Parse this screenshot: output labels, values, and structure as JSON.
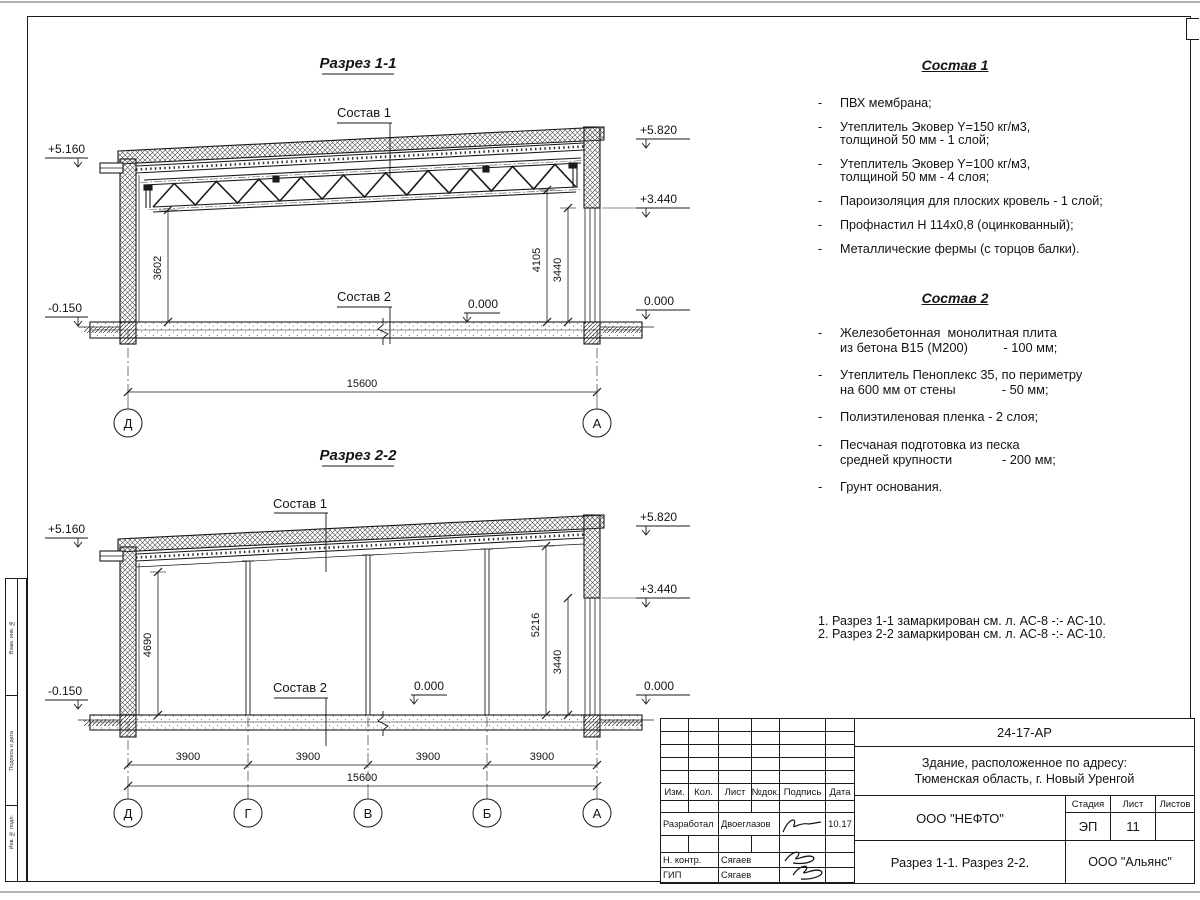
{
  "margin_column": {
    "labels": [
      "Взам. инв. №",
      "Подпись и дата",
      "Инв. № подл."
    ]
  },
  "section1": {
    "title": "Разрез 1-1",
    "callout_top": "Состав 1",
    "callout_floor": "Состав 2",
    "elev": {
      "left_top": "+5.160",
      "left_bottom": "-0.150",
      "right_top": "+5.820",
      "right_mid": "+3.440",
      "right_zero": "0.000",
      "floor_zero": "0.000"
    },
    "dims": {
      "h_left": "3602",
      "h_right1": "4105",
      "h_right2": "3440",
      "total": "15600"
    },
    "grids": [
      "Д",
      "А"
    ]
  },
  "section2": {
    "title": "Разрез 2-2",
    "callout_top": "Состав 1",
    "callout_floor": "Состав 2",
    "elev": {
      "left_top": "+5.160",
      "left_bottom": "-0.150",
      "right_top": "+5.820",
      "right_mid": "+3.440",
      "right_zero": "0.000",
      "floor_zero": "0.000"
    },
    "dims": {
      "h_left": "4690",
      "h_right1": "5216",
      "h_right2": "3440",
      "total": "15600",
      "bays": [
        "3900",
        "3900",
        "3900",
        "3900"
      ]
    },
    "grids": [
      "Д",
      "Г",
      "В",
      "Б",
      "А"
    ]
  },
  "sostav1": {
    "title": "Состав 1",
    "items": [
      [
        "ПВХ мембрана;"
      ],
      [
        "Утеплитель Эковер Y=150 кг/м3,",
        "толщиной 50 мм - 1 слой;"
      ],
      [
        "Утеплитель Эковер Y=100 кг/м3,",
        "толщиной 50 мм - 4 слоя;"
      ],
      [
        "Пароизоляция для плоских кровель - 1 слой;"
      ],
      [
        "Профнастил Н 114х0,8 (оцинкованный);"
      ],
      [
        "Металлические фермы (с торцов балки)."
      ]
    ]
  },
  "sostav2": {
    "title": "Состав 2",
    "items": [
      [
        "Железобетонная  монолитная плита",
        "из бетона В15 (М200)          - 100 мм;"
      ],
      [
        "Утеплитель Пеноплекс 35, по периметру",
        "на 600 мм от стены             - 50 мм;"
      ],
      [
        "Полиэтиленовая пленка - 2 слоя;"
      ],
      [
        "Песчаная подготовка из песка",
        "средней крупности              - 200 мм;"
      ],
      [
        "Грунт основания."
      ]
    ]
  },
  "notes": [
    "1. Разрез 1-1 замаркирован см. л. АС-8 -:- АС-10.",
    "2. Разрез 2-2 замаркирован см. л. АС-8 -:- АС-10."
  ],
  "titleblock": {
    "doc_code": "24-17-АР",
    "project_line1": "Здание, расположенное по адресу:",
    "project_line2": "Тюменская область, г. Новый Уренгой",
    "columns": {
      "izm": "Изм.",
      "kol": "Кол.",
      "list": "Лист",
      "doc": "№док.",
      "sign": "Подпись",
      "date": "Дата"
    },
    "people": [
      {
        "role": "Разработал",
        "name": "Двоеглазов",
        "date": "10.17"
      },
      {
        "role": "Н. контр.",
        "name": "Сягаев",
        "date": ""
      },
      {
        "role": "ГИП",
        "name": "Сягаев",
        "date": ""
      }
    ],
    "client": "ООО \"НЕФТО\"",
    "stage_label": "Стадия",
    "list_label": "Лист",
    "listov_label": "Листов",
    "stage": "ЭП",
    "sheet_number": "11",
    "sheets_total": "",
    "content_title": "Разрез 1-1. Разрез 2-2.",
    "contractor": "ООО \"Альянс\""
  }
}
